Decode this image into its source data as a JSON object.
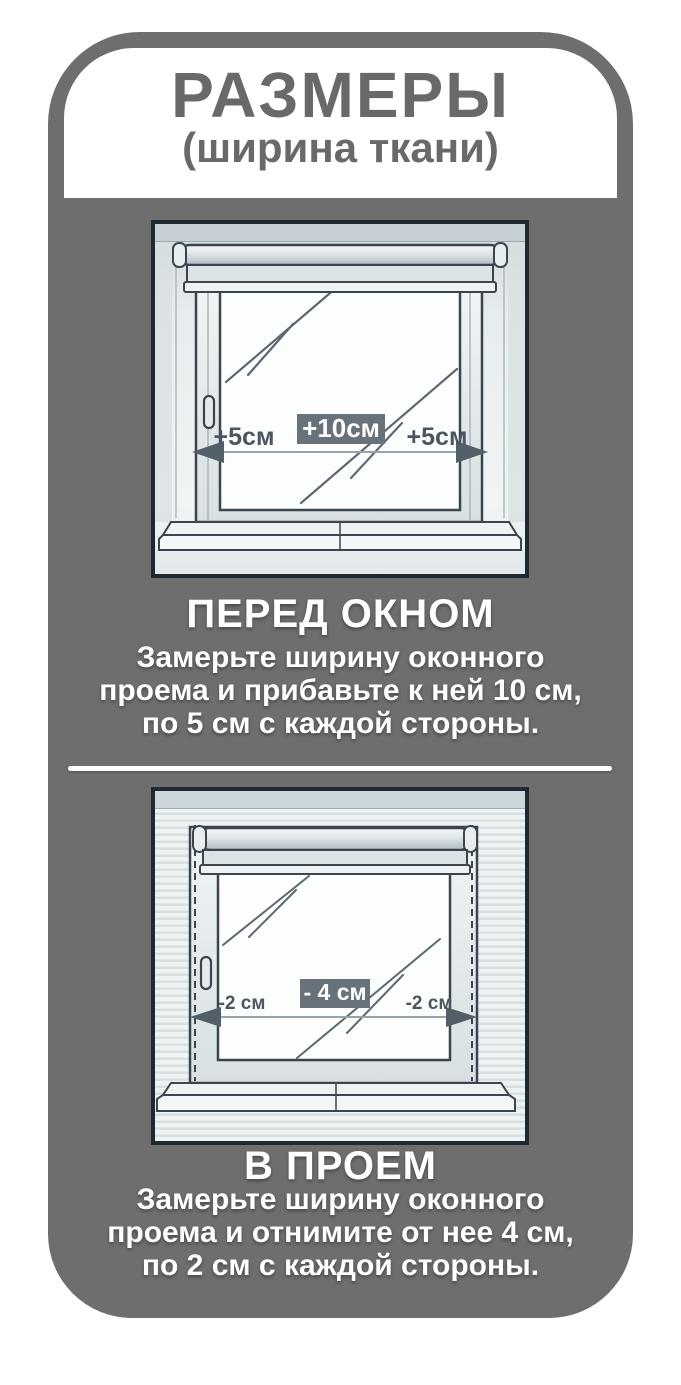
{
  "header": {
    "title": "РАЗМЕРЫ",
    "subtitle": "(ширина ткани)"
  },
  "sections": [
    {
      "id": "front-of-window",
      "heading": "ПЕРЕД ОКНОМ",
      "body_lines": [
        "Замерьте ширину оконного",
        "проема и прибавьте к ней 10 см,",
        "по 5 см с каждой стороны."
      ],
      "labels": {
        "left": "+5см",
        "center": "+10см",
        "right": "+5см"
      }
    },
    {
      "id": "in-recess",
      "heading": "В ПРОЕМ",
      "body_lines": [
        "Замерьте ширину оконного",
        "проема и отнимите от нее 4 см,",
        "по 2 см с каждой стороны."
      ],
      "labels": {
        "left": "-2 см",
        "center": "- 4 см",
        "right": "-2 см"
      }
    }
  ],
  "colors": {
    "page_background": "#ffffff",
    "panel_gray": "#6e6e6e",
    "header_background": "#ffffff",
    "header_text": "#696969",
    "body_text": "#ffffff",
    "badge_fill": "#68727a",
    "badge_text": "#ffffff",
    "diagram_outline": "#3a454d",
    "measure_label_text": "#4b565f",
    "wall_light": "#e7ecee"
  }
}
